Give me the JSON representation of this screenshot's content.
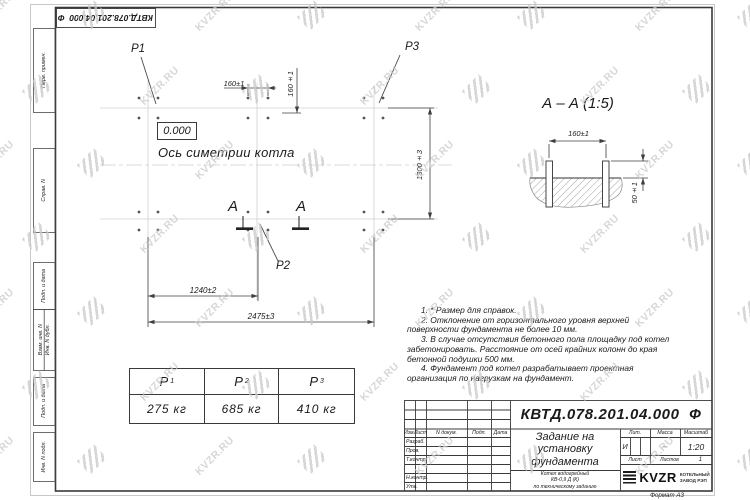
{
  "watermark": {
    "text": "KVZR.RU"
  },
  "sheet": {
    "stamp_rotated": "КВТД.078.201.04.000  Ф",
    "format_note": "Формат А3",
    "side_labels": {
      "perv_primen": "Перв. примен.",
      "sprav_n": "Справ. N",
      "podp_data_1": "Подп. и дата",
      "vzam_inv": "Взам. инв. N",
      "inv_dubl": "Инв. N дубл.",
      "podp_data_2": "Подп. и дата",
      "inv_podl": "Инв. N подл."
    }
  },
  "plan": {
    "label_p1": "P1",
    "label_p2": "P2",
    "label_p3": "P3",
    "level_mark": "0.000",
    "axis_label": "Ось симетрии котла",
    "section_letter_left": "А",
    "section_letter_right": "А",
    "dim_160_top": "160±1",
    "dim_160_side": "160±1",
    "dim_1300": "1300±3",
    "dim_1240": "1240±2",
    "dim_2475": "2475±3"
  },
  "section_view": {
    "title": "А – А (1:5)",
    "dim_160": "160±1",
    "dim_50": "50±1"
  },
  "notes": [
    "1. * Размер для справок.",
    "2. Отклонение от горизонтального уровня верхней поверхности фундамента не более 10 мм.",
    "3. В случае отсутствия бетонного пола площадку под котел забетонировать. Расстояние от осей крайних колонн до края бетонной подушки 500 мм.",
    "4. Фундамент под котел разрабатывает проектная организация по нагрузкам на фундамент."
  ],
  "load_table": {
    "headers": [
      {
        "base": "P",
        "sub": "1"
      },
      {
        "base": "P",
        "sub": "2"
      },
      {
        "base": "P",
        "sub": "3"
      }
    ],
    "values": [
      "275 кг",
      "685 кг",
      "410 кг"
    ]
  },
  "title_block": {
    "doc_number": "КВТД.078.201.04.000  Ф",
    "title": "Задание на установку фундамента",
    "product_lines": [
      "Котел водогрейный",
      "КВ-0,9 Д (К)",
      "по техническому заданию"
    ],
    "columns": {
      "izm": "Изм.",
      "list": "Лист",
      "doc": "N докум.",
      "podp": "Подп.",
      "data": "Дата"
    },
    "rows": {
      "razrab": "Разраб.",
      "prov": "Пров.",
      "tkontr": "Т.контр.",
      "nkontr": "Н.контр.",
      "utv": "Утв."
    },
    "lit_label": "Лит.",
    "lit_value": "И",
    "massa_label": "Масса",
    "massa_value": "–",
    "masshtab_label": "Масштаб",
    "masshtab_value": "1:20",
    "list_label": "Лист",
    "listov_label": "Листов",
    "listov_value": "1",
    "company": {
      "logo_text": "KVZR",
      "name_line1": "КОТЕЛЬНЫЙ",
      "name_line2": "ЗАВОД РЭП"
    }
  }
}
